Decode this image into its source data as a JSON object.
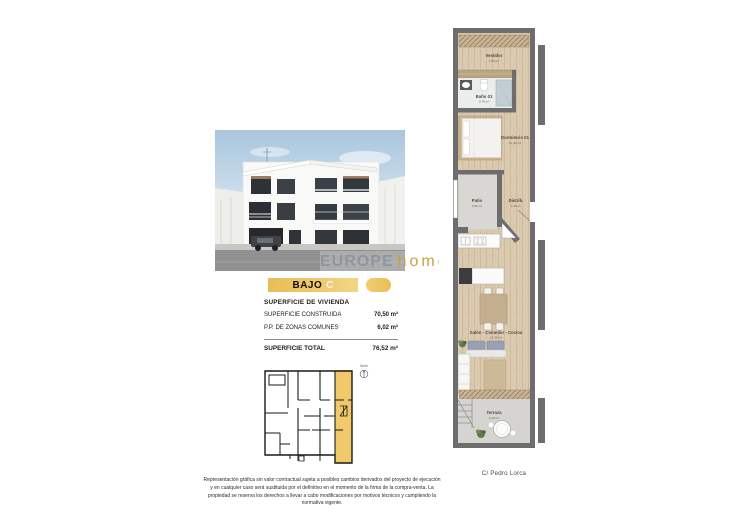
{
  "unit": {
    "bar_label": "BAJO",
    "bar_letter": "C",
    "table": {
      "header": "SUPERFICIE DE VIVIENDA",
      "rows": [
        {
          "label": "SUPERFICIE CONSTRUIDA",
          "value": "70,50 m²"
        },
        {
          "label": "P.P. DE ZONAS COMUNES",
          "value": "6,02 m²"
        }
      ],
      "total": {
        "label": "SUPERFICIE TOTAL",
        "value": "76,52 m²"
      }
    }
  },
  "floorplan": {
    "rooms": [
      {
        "name": "Vestidor",
        "area": "7,80 m²"
      },
      {
        "name": "Baño 01",
        "area": "3,75 m²"
      },
      {
        "name": "Dormitorio 01",
        "area": "11,40 m²"
      },
      {
        "name": "Patio",
        "area": "5,90 m²"
      },
      {
        "name": "Distrib.",
        "area": "4,30 m²"
      },
      {
        "name": "Salón - Comedor - Cocina",
        "area": "27,30 m²"
      },
      {
        "name": "Terraza",
        "area": "4,10 m²"
      }
    ],
    "street": "C/ Pedro Lorca"
  },
  "siteplan": {
    "north": "Norte"
  },
  "watermark": {
    "brand": "EUROPE",
    "suffix": "home"
  },
  "disclaimer": "Representación gráfica sin valor contractual sujeta a posibles cambios derivados del proyecto de ejecución y en cualquier caso será sustituida por el definitivo en el momento de la firma de la compra-venta. La propiedad se reserva los derechos a llevar a cabo modificaciones por motivos técnicos y cumpliendo la normativa vigente.",
  "colors": {
    "accent_gold": "#eec45f",
    "wall_gray": "#6d6d6d",
    "wood": "#dccab0"
  }
}
